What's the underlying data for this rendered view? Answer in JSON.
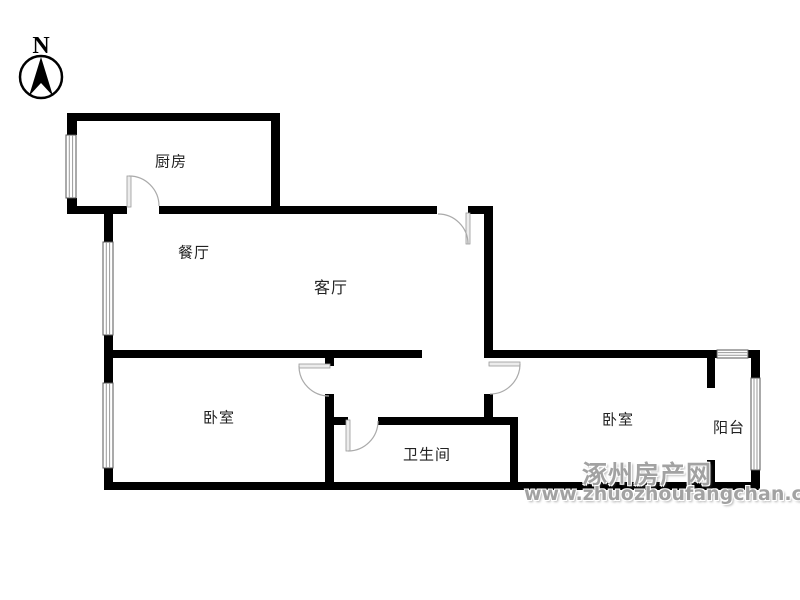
{
  "compass": {
    "label": "N"
  },
  "rooms": {
    "kitchen": "厨房",
    "dining": "餐厅",
    "living": "客厅",
    "bedroom_left": "卧室",
    "bathroom": "卫生间",
    "bedroom_right": "卧室",
    "balcony": "阳台"
  },
  "watermark": {
    "site_name": "涿州房产网",
    "site_url": "www.zhuozhoufangchan.com"
  },
  "colors": {
    "wall": "#000000",
    "door_arc": "#aaaaaa",
    "door_leaf": "#ececec",
    "window_frame": "#555555",
    "window_pane": "#999999",
    "watermark": "#a2a2a2"
  }
}
